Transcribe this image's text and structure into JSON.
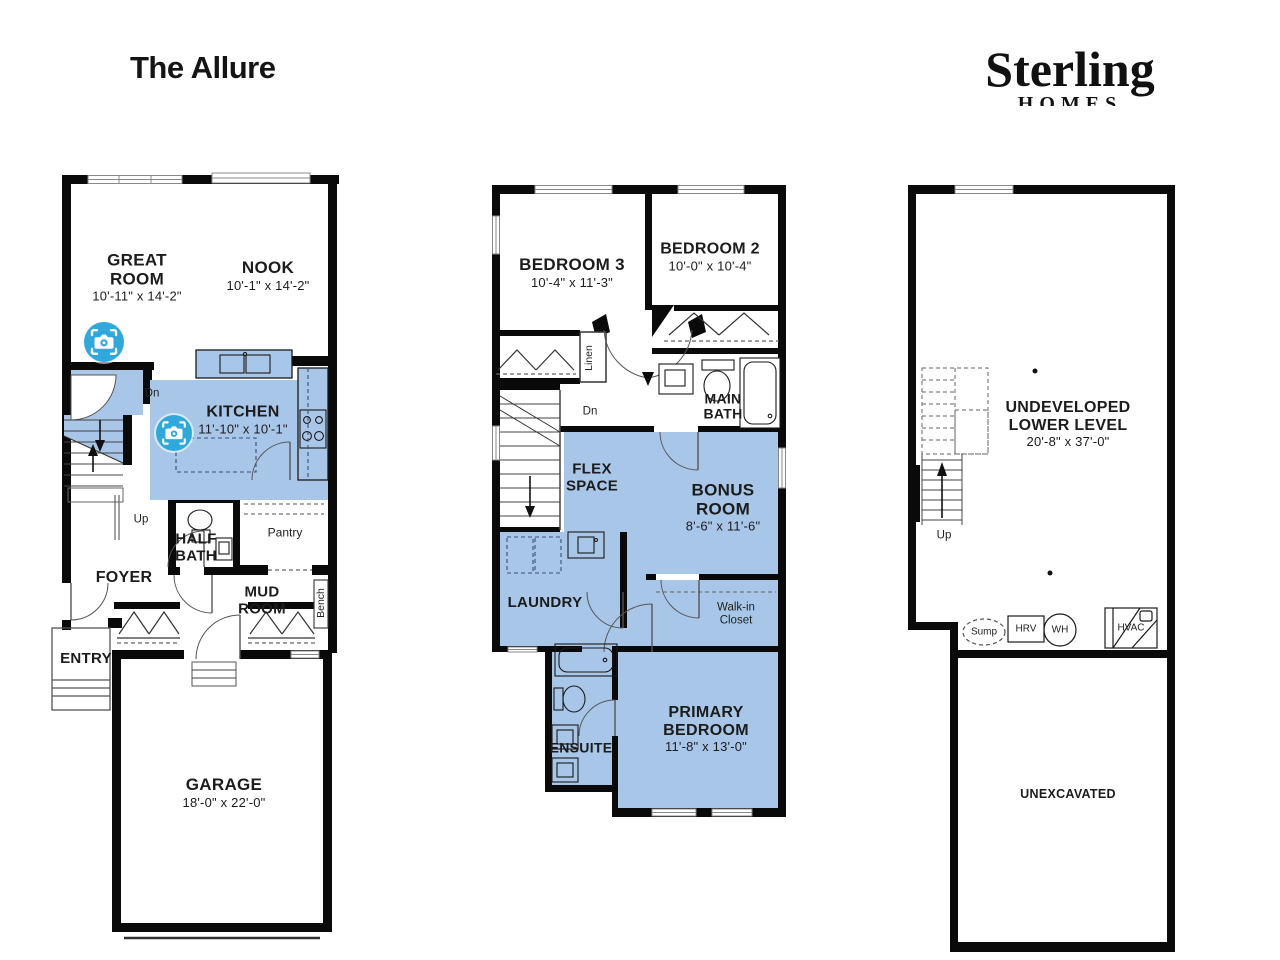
{
  "title": "The Allure",
  "brand": {
    "name": "Sterling",
    "sub": "HOMES"
  },
  "colors": {
    "room_fill": "#a8c6e8",
    "camera_blue": "#2fa9dc",
    "wall": "#0a0a0a"
  },
  "main_floor": {
    "great_room": {
      "label": "GREAT ROOM",
      "dims": "10'-11\" x 14'-2\""
    },
    "nook": {
      "label": "NOOK",
      "dims": "10'-1\" x 14'-2\""
    },
    "kitchen": {
      "label": "KITCHEN",
      "dims": "11'-10\" x 10'-1\""
    },
    "half_bath": {
      "label": "HALF BATH"
    },
    "pantry": {
      "label": "Pantry"
    },
    "foyer": {
      "label": "FOYER"
    },
    "mud_room": {
      "label": "MUD ROOM"
    },
    "bench": {
      "label": "Bench"
    },
    "entry": {
      "label": "ENTRY"
    },
    "garage": {
      "label": "GARAGE",
      "dims": "18'-0\" x 22'-0\""
    },
    "dn": "Dn",
    "up": "Up"
  },
  "upper_floor": {
    "bedroom_3": {
      "label": "BEDROOM 3",
      "dims": "10'-4\" x 11'-3\""
    },
    "bedroom_2": {
      "label": "BEDROOM 2",
      "dims": "10'-0\" x 10'-4\""
    },
    "linen": {
      "label": "Linen"
    },
    "main_bath": {
      "label": "MAIN BATH"
    },
    "flex_space": {
      "label": "FLEX SPACE"
    },
    "bonus_room": {
      "label": "BONUS ROOM",
      "dims": "8'-6\" x 11'-6\""
    },
    "laundry": {
      "label": "LAUNDRY"
    },
    "walk_in_closet": {
      "label": "Walk-in Closet"
    },
    "ensuite": {
      "label": "ENSUITE"
    },
    "primary_bedroom": {
      "label": "PRIMARY BEDROOM",
      "dims": "11'-8\" x 13'-0\""
    },
    "dn": "Dn"
  },
  "basement": {
    "undeveloped": {
      "label": "UNDEVELOPED LOWER LEVEL",
      "dims": "20'-8\" x 37'-0\""
    },
    "unexcavated": {
      "label": "UNEXCAVATED"
    },
    "up": "Up",
    "sump": "Sump",
    "hrv": "HRV",
    "wh": "WH",
    "hvac": "HVAC"
  }
}
